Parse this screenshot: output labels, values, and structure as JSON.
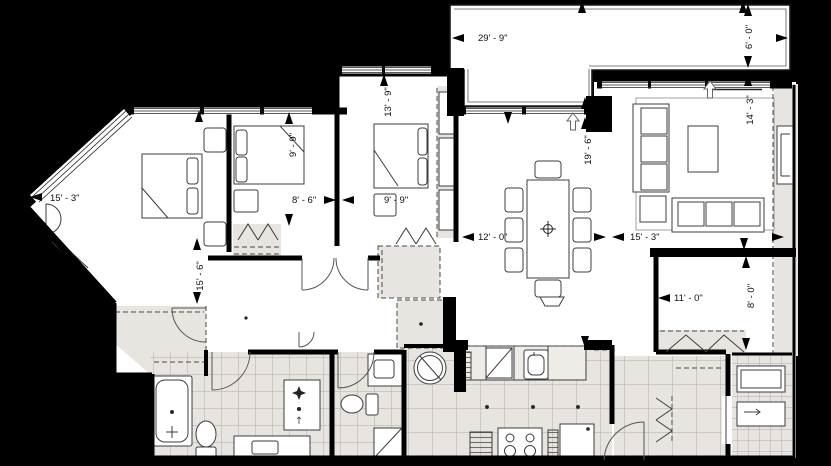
{
  "plan": {
    "type": "residential-unit-floor-plan",
    "colors": {
      "background": "#000000",
      "floor": "#ffffff",
      "zone": "#e8e4df",
      "wall": "#000000",
      "line": "#3d3d3d",
      "tile_line": "#b2ada7",
      "text": "#111111"
    },
    "dims": {
      "balcony_w": "29' - 9\"",
      "balcony_d": "6' - 0\"",
      "bedroom1_w": "15' - 3\"",
      "bedroom2_w": "8' - 6\"",
      "bedroom2_d": "9' - 9\"",
      "bedroom3_w": "9' - 9\"",
      "bedroom3_d": "13' - 9\"",
      "greatroom_d": "19' - 6\"",
      "dining_w": "12' - 0\"",
      "living_w": "15' - 3\"",
      "living_d": "14' - 3\"",
      "hall_d": "15' - 6\"",
      "entry_w": "11' - 0\"",
      "entry_d": "8' - 0\""
    },
    "symbols": {
      "balcony_access": "up-arrow",
      "table_center": "center-crosshair"
    }
  }
}
